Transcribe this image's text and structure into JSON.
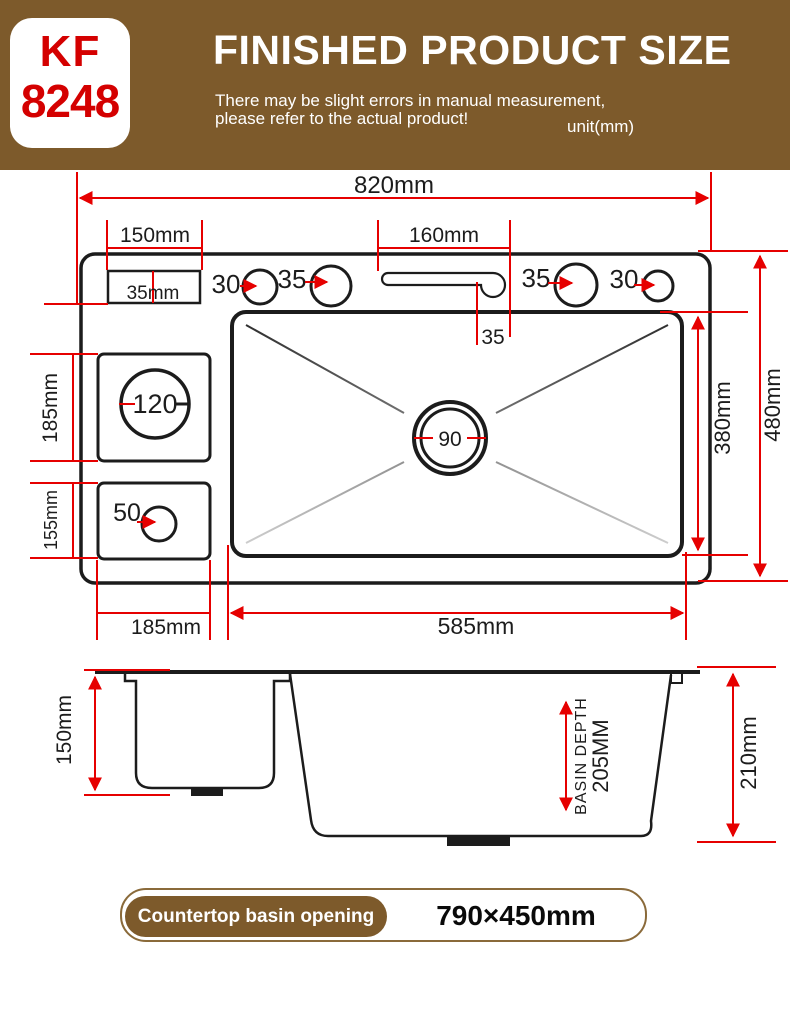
{
  "header": {
    "model_top": "KF",
    "model_bottom": "8248",
    "title": "FINISHED PRODUCT SIZE",
    "subtitle_line1": "There may be slight errors in manual measurement,",
    "subtitle_line2": "please refer to the actual product!",
    "unit_note": "unit(mm)"
  },
  "top_view": {
    "overall_width": "820mm",
    "left_plate_width": "150mm",
    "faucet_slot_width": "160mm",
    "plate_depth": "35mm",
    "hole_left_outer": "30",
    "hole_left_inner": "35",
    "slot_to_basin": "35",
    "hole_right_inner": "35",
    "hole_right_outer": "30",
    "upper_box_height": "185mm",
    "lower_box_height": "155mm",
    "waste_hole": "120",
    "drain_hole": "90",
    "small_hole": "50",
    "basin_inner_height": "380mm",
    "overall_height": "480mm",
    "left_col_width": "185mm",
    "basin_inner_width": "585mm"
  },
  "side_view": {
    "left_basin_depth": "150mm",
    "basin_depth_label": "BASIN DEPTH",
    "basin_depth_value": "205MM",
    "overall_depth": "210mm"
  },
  "footer": {
    "label": "Countertop basin opening",
    "value": "790×450mm"
  },
  "colors": {
    "header_brown": "#7d5a2b",
    "accent_red": "#e60000",
    "model_red": "#d40000",
    "line_black": "#1c1c1c",
    "footer_border_brown": "#8a6a3a"
  }
}
